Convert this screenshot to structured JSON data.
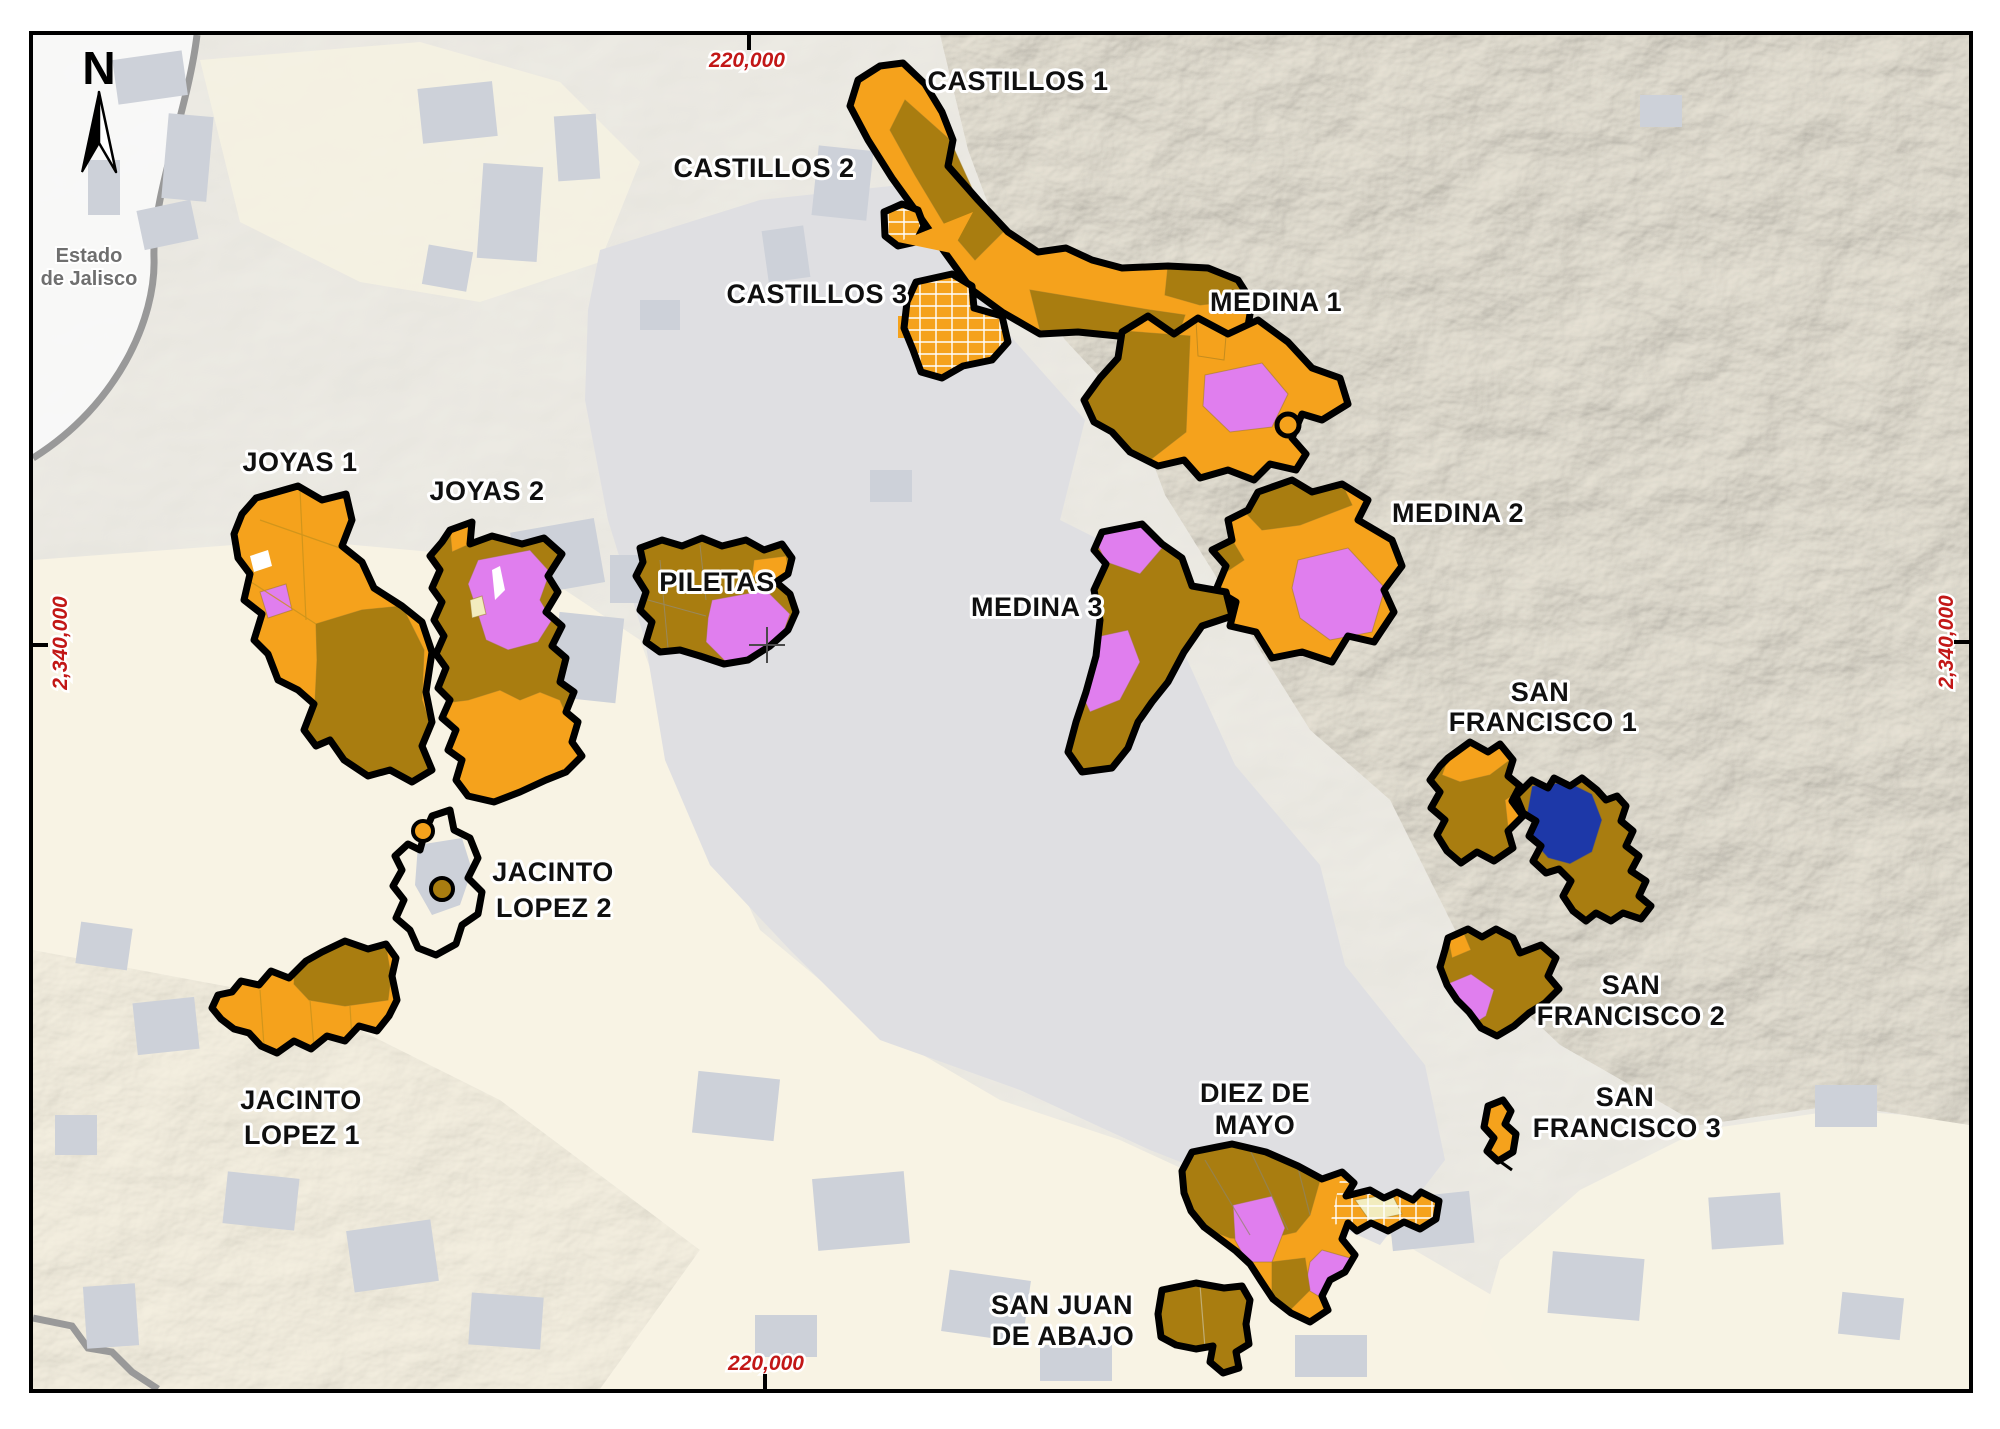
{
  "map": {
    "compass": {
      "label": "N"
    },
    "neighbor_state": {
      "lines": [
        "Estado",
        "de Jalisco"
      ]
    },
    "grid_labels": {
      "top": "220,000",
      "bottom": "220,000",
      "left": "2,340,000",
      "right": "2,340,000"
    },
    "colors": {
      "parcel_orange": "#F5A21C",
      "parcel_brown": "#A97D10",
      "parcel_violet": "#E07EEE",
      "parcel_blue": "#1D38A8",
      "parcel_cream": "#F2ECBE",
      "ejido_outline": "#000000",
      "coordinate_red": "#C21717",
      "urban_gray": "#CDD1D9",
      "valley_gray": "#DFDFE2",
      "background_cream": "#F8F3E4",
      "terrain_beige": "#E7E2D4",
      "state_boundary_gray": "#999999",
      "label_halo": "#FFFFFF"
    },
    "ejidos": [
      {
        "id": "castillos-1",
        "lines": [
          "CASTILLOS 1"
        ]
      },
      {
        "id": "castillos-2",
        "lines": [
          "CASTILLOS 2"
        ]
      },
      {
        "id": "castillos-3",
        "lines": [
          "CASTILLOS 3"
        ]
      },
      {
        "id": "medina-1",
        "lines": [
          "MEDINA 1"
        ]
      },
      {
        "id": "medina-2",
        "lines": [
          "MEDINA 2"
        ]
      },
      {
        "id": "medina-3",
        "lines": [
          "MEDINA 3"
        ]
      },
      {
        "id": "joyas-1",
        "lines": [
          "JOYAS 1"
        ]
      },
      {
        "id": "joyas-2",
        "lines": [
          "JOYAS 2"
        ]
      },
      {
        "id": "piletas",
        "lines": [
          "PILETAS"
        ]
      },
      {
        "id": "jacinto-lopez-2",
        "lines": [
          "JACINTO",
          "LOPEZ 2"
        ]
      },
      {
        "id": "jacinto-lopez-1",
        "lines": [
          "JACINTO",
          "LOPEZ 1"
        ]
      },
      {
        "id": "san-francisco-1",
        "lines": [
          "SAN",
          "FRANCISCO 1"
        ]
      },
      {
        "id": "san-francisco-2",
        "lines": [
          "SAN",
          "FRANCISCO 2"
        ]
      },
      {
        "id": "san-francisco-3",
        "lines": [
          "SAN",
          "FRANCISCO 3"
        ]
      },
      {
        "id": "diez-de-mayo",
        "lines": [
          "DIEZ DE",
          "MAYO"
        ]
      },
      {
        "id": "san-juan-de-abajo",
        "lines": [
          "SAN JUAN",
          "DE ABAJO"
        ]
      }
    ]
  }
}
